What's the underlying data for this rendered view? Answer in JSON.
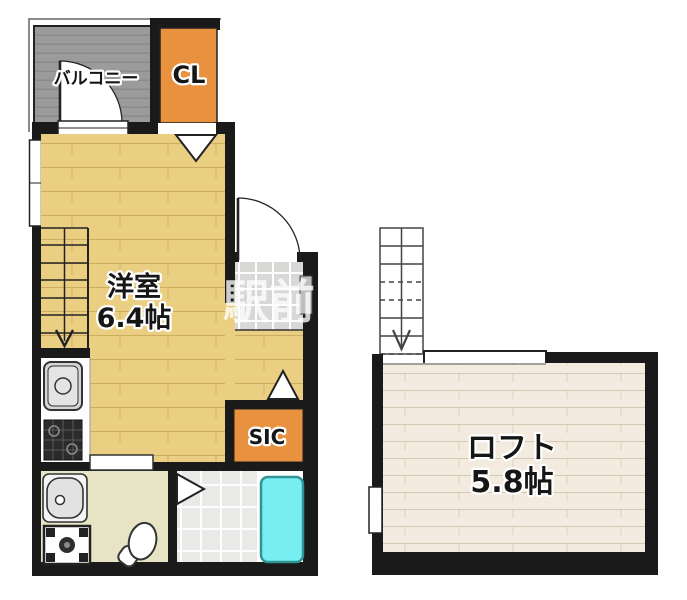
{
  "rooms": {
    "balcony": {
      "label": "バルコニー"
    },
    "closet": {
      "label": "CL"
    },
    "western_room": {
      "label": "洋室",
      "size": "6.4帖"
    },
    "shoe_closet": {
      "label": "SIC"
    },
    "loft": {
      "label": "ロフト",
      "size": "5.8帖"
    }
  },
  "watermark": {
    "text": "駅前"
  },
  "colors": {
    "wall": "#1a1a1a",
    "balcony_gray": "#9b9b9b",
    "closet_orange": "#e8913e",
    "room_tan": "#eace82",
    "loft_cream": "#f3ebdf",
    "washroom_beige": "#e7e4c6",
    "genkan_tile": "#d8d8d6",
    "shower_tile": "#e9e9e7",
    "bathtub_cyan": "#79eef1",
    "step_gray": "#bdbdbd"
  }
}
